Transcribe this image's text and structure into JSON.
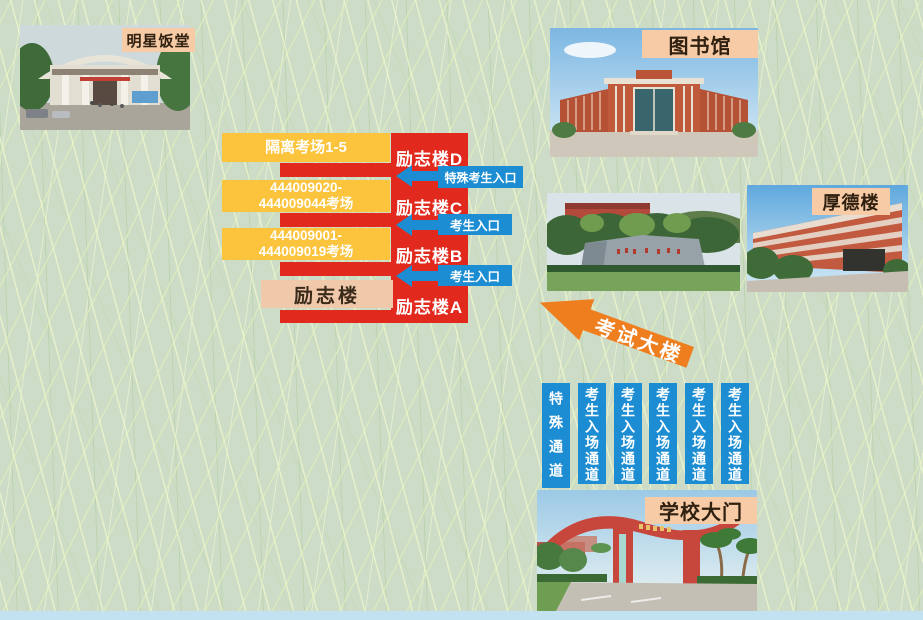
{
  "photos": {
    "canteen_label": "明星饭堂",
    "library_label": "图书馆",
    "houde_label": "厚德楼",
    "gate_label": "学校大门"
  },
  "diagram": {
    "tower_floors": [
      "励志楼D",
      "励志楼C",
      "励志楼B",
      "励志楼A"
    ],
    "room_blocks": [
      {
        "line1": "隔离考场1-5",
        "line2": ""
      },
      {
        "line1": "444009020-",
        "line2": "444009044考场"
      },
      {
        "line1": "444009001-",
        "line2": "444009019考场"
      }
    ],
    "building_label": "励志楼",
    "entrances": [
      "特殊考生入口",
      "考生入口",
      "考生入口"
    ]
  },
  "exam_building": {
    "label": "考试大楼"
  },
  "channels": [
    "特殊通道",
    "考生入场通道",
    "考生入场通道",
    "考生入场通道",
    "考生入场通道",
    "考生入场通道"
  ],
  "colors": {
    "red": "#e2291d",
    "yellow": "#fcc33c",
    "blue": "#1c8dd2",
    "peach_label": "#f6cba6",
    "pink_block": "#f0c9ab",
    "orange_arrow": "#ee7e1e",
    "grass_base": "#ccdcc6",
    "bottom_strip": "#c3e2f1"
  }
}
